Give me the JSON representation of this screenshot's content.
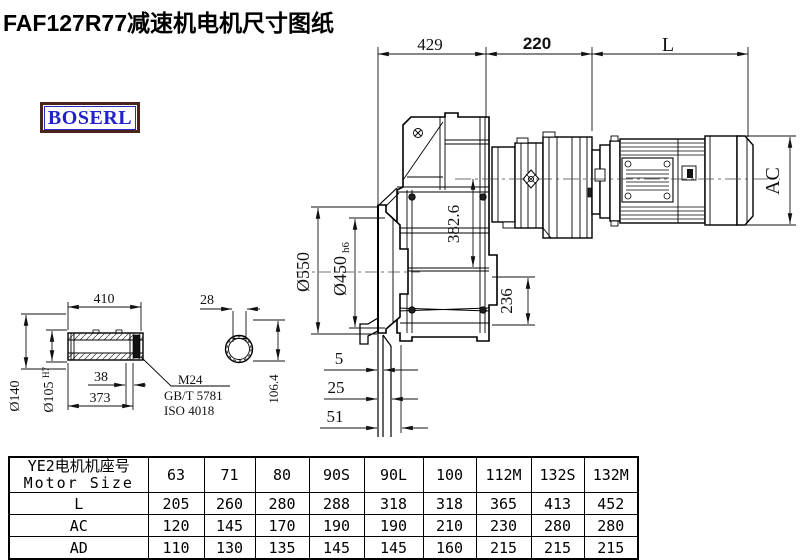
{
  "title": "FAF127R77减速机电机尺寸图纸",
  "logo": "BOSERL",
  "drawing": {
    "top_dims": {
      "d429": "429",
      "d220": "220",
      "dL": "L"
    },
    "right_dim": {
      "ac": "AC"
    },
    "left_dims": {
      "d550": "Ø550",
      "d450": "Ø450",
      "d450_tol": "h6"
    },
    "inner_dims": {
      "d382": "382.6",
      "d236": "236"
    },
    "offset_dims": {
      "d5": "5",
      "d25": "25",
      "d51": "51"
    },
    "shaft": {
      "d410": "410",
      "d140": "Ø140",
      "d105": "Ø105",
      "d105_tol": "H7",
      "d38": "38",
      "d373": "373",
      "thread": "M24",
      "std1": "GB/T 5781",
      "std2": "ISO 4018"
    },
    "bore": {
      "d28": "28",
      "d1064": "106.4"
    }
  },
  "table": {
    "header_cn": "YE2电机机座号",
    "header_en": "Motor Size",
    "columns": [
      "63",
      "71",
      "80",
      "90S",
      "90L",
      "100",
      "112M",
      "132S",
      "132M"
    ],
    "rows": [
      {
        "label": "L",
        "values": [
          "205",
          "260",
          "280",
          "288",
          "318",
          "318",
          "365",
          "413",
          "452"
        ]
      },
      {
        "label": "AC",
        "values": [
          "120",
          "145",
          "170",
          "190",
          "190",
          "210",
          "230",
          "280",
          "280"
        ]
      },
      {
        "label": "AD",
        "values": [
          "110",
          "130",
          "135",
          "145",
          "145",
          "160",
          "215",
          "215",
          "215"
        ]
      }
    ]
  }
}
